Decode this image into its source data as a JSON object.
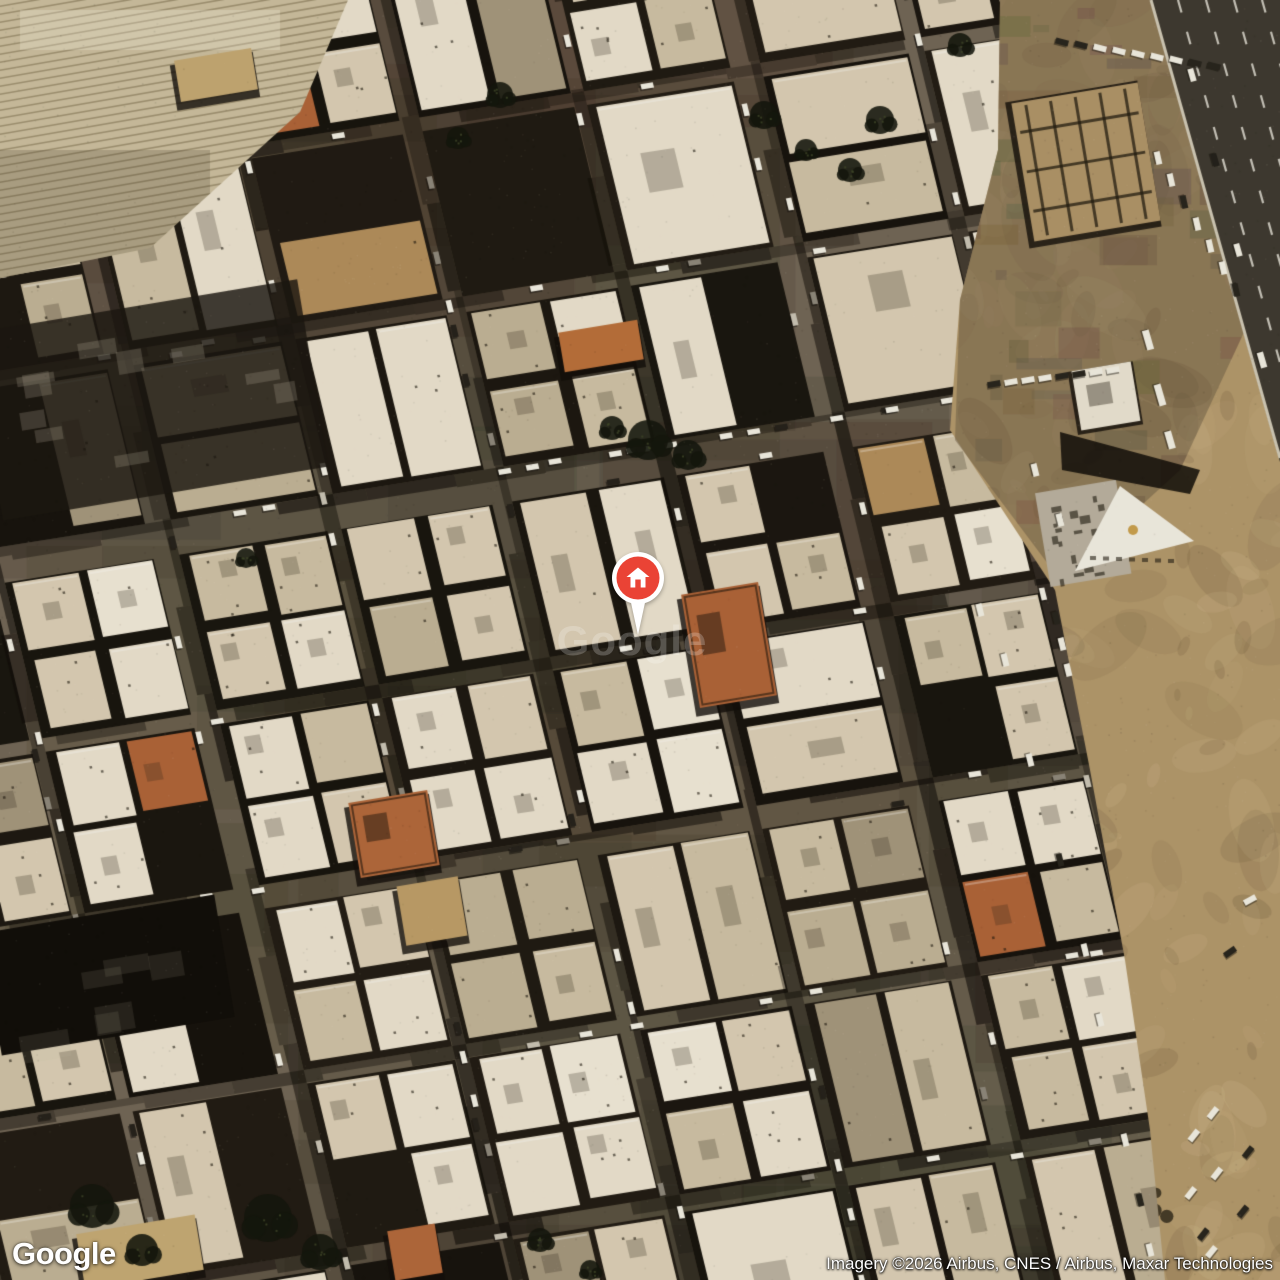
{
  "map": {
    "view": "satellite",
    "watermark_text": "Google",
    "marker": {
      "kind": "home",
      "x": 638,
      "y": 578,
      "pin_color": "#EA4335",
      "ring_color": "#FFFFFF",
      "icon": "home-icon"
    },
    "colors": {
      "street": "#6e6354",
      "shadow": "#0d0b07",
      "sand": "#b0966a",
      "dirt_overlay": "rgba(95,82,62,0.45)",
      "farmland": "#c9bd9e",
      "highway": "#3a362e",
      "lane_marking": "#e8e4da",
      "roof_light": "#e9e1cf",
      "roof_mid": "#d9cdb5",
      "roof_dark": "#bfb296",
      "roof_orange": "#ad6136",
      "roof_tan": "#bb9c66",
      "car_white": "#f0ede3",
      "triangle_roof": "#f0ede3",
      "triangle_dot": "#c79e4b"
    },
    "render_seed": 7
  },
  "branding": {
    "logo_text": "Google"
  },
  "attribution": {
    "text": "Imagery ©2026 Airbus, CNES / Airbus, Maxar Technologies"
  }
}
